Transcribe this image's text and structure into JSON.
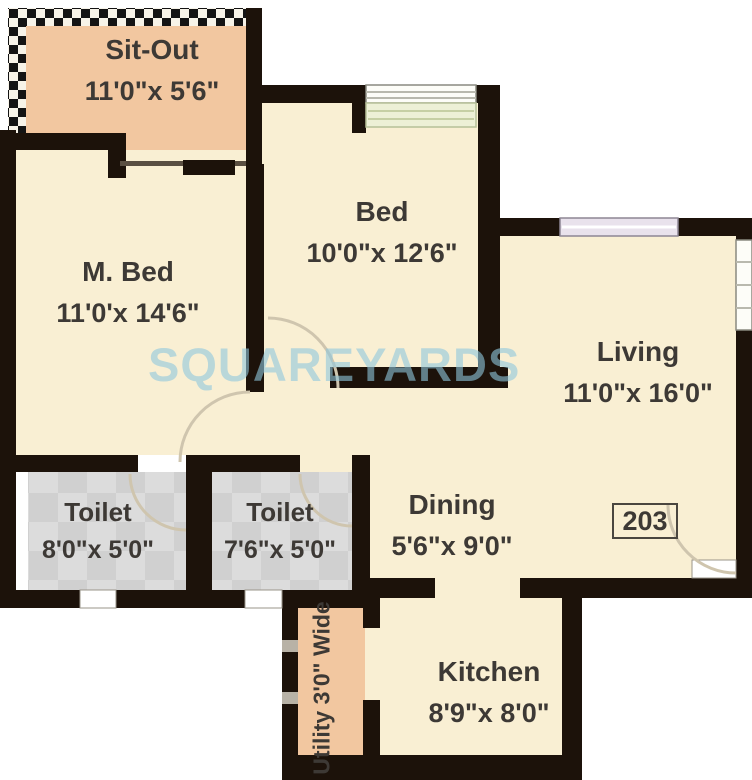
{
  "plan": {
    "watermark": "SQUAREYARDS",
    "unit_number": "203",
    "rooms": {
      "sitout": {
        "name": "Sit-Out",
        "dims": "11'0\"x 5'6\""
      },
      "mbed": {
        "name": "M. Bed",
        "dims": "11'0'x 14'6\""
      },
      "bed": {
        "name": "Bed",
        "dims": "10'0\"x 12'6\""
      },
      "living": {
        "name": "Living",
        "dims": "11'0\"x 16'0\""
      },
      "toilet1": {
        "name": "Toilet",
        "dims": "8'0\"x 5'0\""
      },
      "toilet2": {
        "name": "Toilet",
        "dims": "7'6\"x 5'0\""
      },
      "dining": {
        "name": "Dining",
        "dims": "5'6\"x 9'0\""
      },
      "kitchen": {
        "name": "Kitchen",
        "dims": "8'9\"x 8'0\""
      }
    },
    "utility_label": "Utility 3'0\" Wide"
  },
  "colors": {
    "c-cream": "#f9efd3",
    "c-peach": "#f2c7a0",
    "c-wall": "#1c120a",
    "c-tile-a": "#dcdcdc",
    "c-tile-b": "#d0d0d0",
    "c-text": "#3d3935",
    "c-watermark": "#8fc8de",
    "c-arc": "#cfc5ae"
  }
}
